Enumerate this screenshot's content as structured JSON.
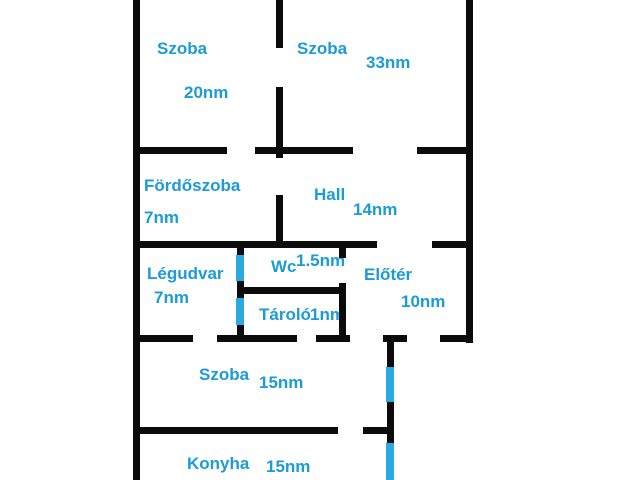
{
  "title": "apartment-floor-plan",
  "colors": {
    "wall": "#0b0b0b",
    "window_marker": "#29abe2",
    "label_text": "#1b9bd7",
    "background": "#ffffff"
  },
  "rooms": {
    "szoba_20": {
      "name": "Szoba",
      "area": "20nm"
    },
    "szoba_33": {
      "name": "Szoba",
      "area": "33nm"
    },
    "fordoszoba": {
      "name": "Fördőszoba",
      "area": "7nm"
    },
    "hall": {
      "name": "Hall",
      "area": "14nm"
    },
    "legudvar": {
      "name": "Légudvar",
      "area": "7nm"
    },
    "wc": {
      "name": "Wc",
      "area": "1.5nm"
    },
    "tarolo": {
      "name": "Tároló",
      "area": "1nm"
    },
    "eloter": {
      "name": "Előtér",
      "area": "10nm"
    },
    "szoba_15": {
      "name": "Szoba",
      "area": "15nm"
    },
    "konyha": {
      "name": "Konyha",
      "area": "15nm"
    }
  },
  "floorplan": {
    "walls": [
      {
        "x": 133,
        "y": 0,
        "w": 7,
        "h": 480
      },
      {
        "x": 276,
        "y": 0,
        "w": 7,
        "h": 48
      },
      {
        "x": 276,
        "y": 87,
        "w": 7,
        "h": 71
      },
      {
        "x": 276,
        "y": 195,
        "w": 7,
        "h": 53
      },
      {
        "x": 466,
        "y": 0,
        "w": 7,
        "h": 343
      },
      {
        "x": 237,
        "y": 246,
        "w": 7,
        "h": 92
      },
      {
        "x": 339,
        "y": 241,
        "w": 7,
        "h": 17
      },
      {
        "x": 339,
        "y": 283,
        "w": 7,
        "h": 55
      },
      {
        "x": 387,
        "y": 338,
        "w": 7,
        "h": 142
      },
      {
        "x": 133,
        "y": 147,
        "w": 94,
        "h": 7
      },
      {
        "x": 255,
        "y": 147,
        "w": 98,
        "h": 7
      },
      {
        "x": 417,
        "y": 147,
        "w": 56,
        "h": 7
      },
      {
        "x": 133,
        "y": 241,
        "w": 244,
        "h": 7
      },
      {
        "x": 432,
        "y": 241,
        "w": 41,
        "h": 7
      },
      {
        "x": 237,
        "y": 287,
        "w": 109,
        "h": 7
      },
      {
        "x": 133,
        "y": 335,
        "w": 60,
        "h": 7
      },
      {
        "x": 217,
        "y": 335,
        "w": 80,
        "h": 7
      },
      {
        "x": 316,
        "y": 335,
        "w": 34,
        "h": 7
      },
      {
        "x": 383,
        "y": 335,
        "w": 24,
        "h": 7
      },
      {
        "x": 440,
        "y": 335,
        "w": 33,
        "h": 7
      },
      {
        "x": 133,
        "y": 427,
        "w": 205,
        "h": 7
      },
      {
        "x": 363,
        "y": 427,
        "w": 31,
        "h": 7
      }
    ],
    "windows": [
      {
        "x": 236,
        "y": 255,
        "w": 8,
        "h": 26
      },
      {
        "x": 236,
        "y": 298,
        "w": 8,
        "h": 27
      },
      {
        "x": 386,
        "y": 367,
        "w": 8,
        "h": 35
      },
      {
        "x": 386,
        "y": 443,
        "w": 8,
        "h": 37
      }
    ]
  }
}
